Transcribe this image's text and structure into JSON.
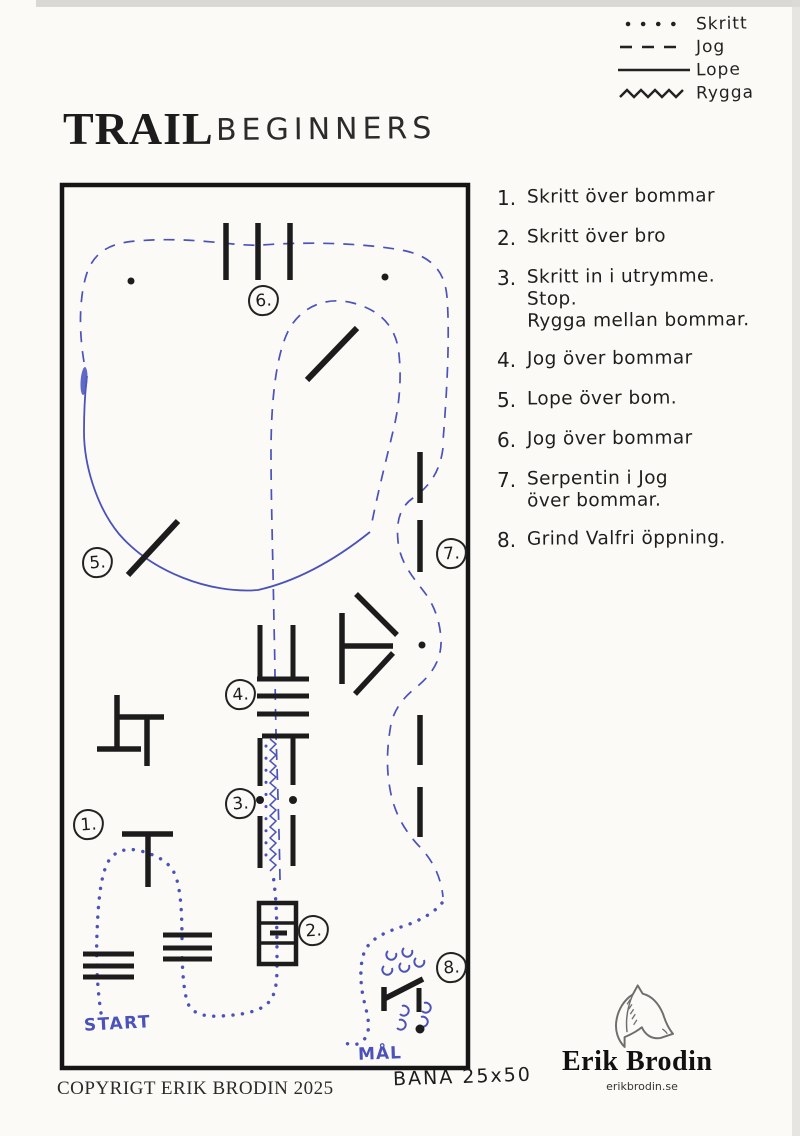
{
  "title": {
    "main": "TRAIL",
    "sub": "BEGINNERS"
  },
  "legend": {
    "items": [
      {
        "label": "Skritt",
        "line_style": "dotted"
      },
      {
        "label": "Jog",
        "line_style": "dashed"
      },
      {
        "label": "Lope",
        "line_style": "solid"
      },
      {
        "label": "Rygga",
        "line_style": "zigzag"
      }
    ]
  },
  "instructions": [
    {
      "num": "1.",
      "text": "Skritt över bommar"
    },
    {
      "num": "2.",
      "text": "Skritt över bro"
    },
    {
      "num": "3.",
      "text": "Skritt in i utrymme.\nStop.\nRygga mellan bommar."
    },
    {
      "num": "4.",
      "text": "Jog över bommar"
    },
    {
      "num": "5.",
      "text": "Lope över bom."
    },
    {
      "num": "6.",
      "text": "Jog över bommar"
    },
    {
      "num": "7.",
      "text": "Serpentin i Jog\növer bommar."
    },
    {
      "num": "8.",
      "text": "Grind Valfri öppning."
    }
  ],
  "map": {
    "markers": [
      {
        "label": "1."
      },
      {
        "label": "2."
      },
      {
        "label": "3."
      },
      {
        "label": "4."
      },
      {
        "label": "5."
      },
      {
        "label": "6."
      },
      {
        "label": "7."
      },
      {
        "label": "8."
      }
    ],
    "start_label": "START",
    "goal_label": "MÅL",
    "arena_size": "BANA 25x50"
  },
  "footer": {
    "copyright": "COPYRIGT ERIK BRODIN 2025"
  },
  "logo": {
    "name": "Erik Brodin",
    "url": "erikbrodin.se"
  },
  "colors": {
    "ink": "#1c1c1c",
    "pen_blue": "#4b52b9",
    "paper": "#fbfaf7"
  }
}
